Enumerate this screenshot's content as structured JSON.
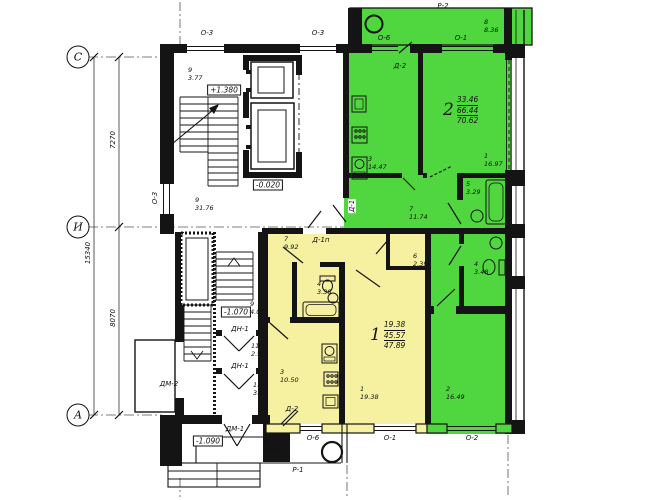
{
  "axes": {
    "c": "С",
    "i": "И",
    "a": "А"
  },
  "dimensions": {
    "total": "15340",
    "upper": "7270",
    "lower": "8070"
  },
  "elevations": {
    "stair_mid": "+1.380",
    "ground": "-0.020",
    "lobby": "-1.070",
    "entry": "-1.090"
  },
  "apartments": {
    "apt2": {
      "num": "2",
      "living": "33.46",
      "total": "66.44",
      "full": "70.62"
    },
    "apt1": {
      "num": "1",
      "living": "19.38",
      "total": "45.57",
      "full": "47.89"
    }
  },
  "rooms": {
    "stair_landing": {
      "num": "9",
      "area": "3.77"
    },
    "corridor": {
      "num": "9",
      "area": "31.76"
    },
    "g_balcony": {
      "num": "8",
      "area": "8.36"
    },
    "g_kitchen": {
      "num": "3",
      "area": "14.47"
    },
    "g_room1": {
      "num": "1",
      "area": "16.97"
    },
    "g_bath": {
      "num": "5",
      "area": "3.29"
    },
    "g_hall": {
      "num": "7",
      "area": "11.74"
    },
    "g_wc": {
      "num": "4",
      "area": "3.48"
    },
    "g_room2": {
      "num": "2",
      "area": "16.49"
    },
    "y_hall": {
      "num": "7",
      "area": "9.92"
    },
    "y_bath": {
      "num": "4",
      "area": "3.38"
    },
    "y_closet": {
      "num": "6",
      "area": "2.39"
    },
    "y_kitchen": {
      "num": "3",
      "area": "10.50"
    },
    "y_room": {
      "num": "1",
      "area": "19.38"
    },
    "lobby": {
      "num": "9",
      "area": "4.07"
    },
    "vestibule1": {
      "num": "11",
      "area": "2.94"
    },
    "vestibule2": {
      "num": "11",
      "area": "3.91"
    },
    "porch": {
      "num": "8",
      "area": "4.64"
    }
  },
  "openings": {
    "p2": "Р-2",
    "p1": "Р-1",
    "o3_top_left": "О-3",
    "o3_top_right": "О-3",
    "o3_side": "О-3",
    "o6_top": "О-6",
    "o6_bottom": "О-6",
    "o1_top": "О-1",
    "o1_bottom": "О-1",
    "o2_bottom": "О-2",
    "d2_top": "Д-2",
    "d2_bottom": "Д-2",
    "d1": "Д-1",
    "d1p": "Д-1п",
    "dn1_upper": "ДН-1",
    "dn1_lower": "ДН-1",
    "dm1": "ДМ-1",
    "dm2": "ДМ-2"
  },
  "colors": {
    "apartment2": "#50d63e",
    "apartment1": "#f6f1a1",
    "wall": "#141414"
  }
}
